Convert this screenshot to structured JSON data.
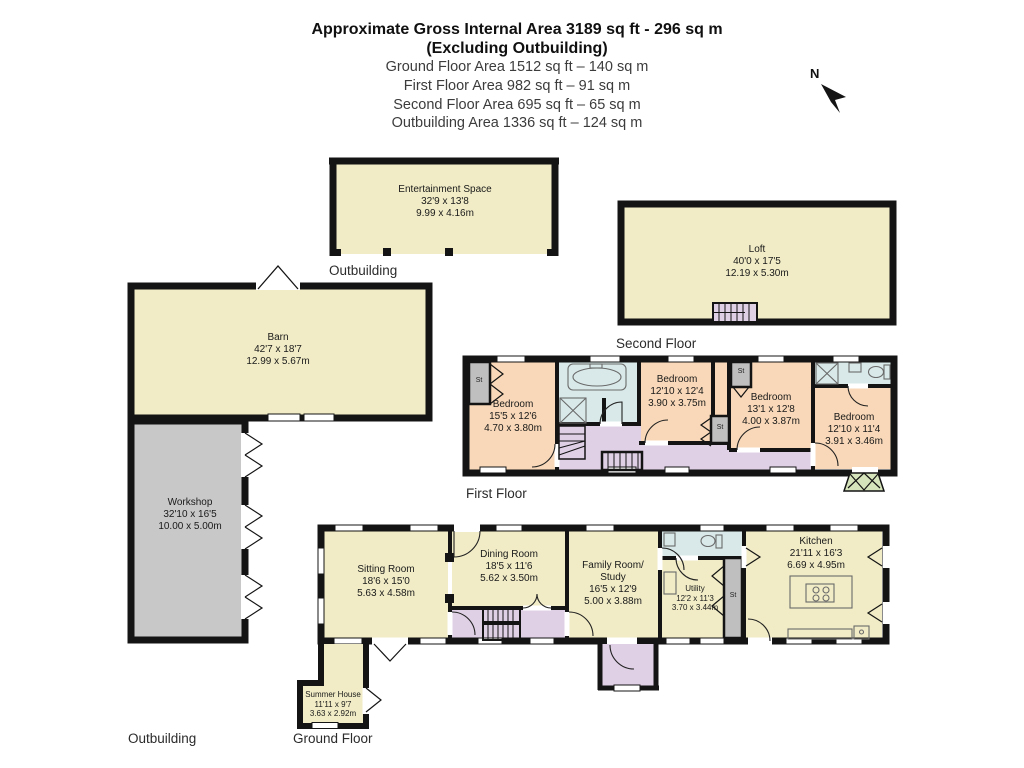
{
  "header": {
    "title": "Approximate Gross Internal Area 3189 sq ft - 296 sq m",
    "subtitle": "(Excluding Outbuilding)",
    "area_lines": [
      "Ground Floor Area 1512 sq ft – 140 sq m",
      "First Floor Area 982 sq ft – 91 sq m",
      "Second Floor Area 695 sq ft – 65 sq m",
      "Outbuilding Area 1336 sq ft – 124 sq m"
    ]
  },
  "compass": {
    "north_label": "N"
  },
  "floor_labels": {
    "outbuilding_top": "Outbuilding",
    "second_floor": "Second Floor",
    "first_floor": "First Floor",
    "outbuilding_bottom": "Outbuilding",
    "ground_floor": "Ground Floor"
  },
  "closet_label": "St",
  "rooms": {
    "entertainment_space": {
      "name": "Entertainment Space",
      "imperial": "32'9 x 13'8",
      "metric": "9.99 x 4.16m"
    },
    "loft": {
      "name": "Loft",
      "imperial": "40'0 x 17'5",
      "metric": "12.19 x 5.30m"
    },
    "barn": {
      "name": "Barn",
      "imperial": "42'7 x 18'7",
      "metric": "12.99 x 5.67m"
    },
    "workshop": {
      "name": "Workshop",
      "imperial": "32'10 x 16'5",
      "metric": "10.00 x 5.00m"
    },
    "bedroom_1": {
      "name": "Bedroom",
      "imperial": "15'5 x 12'6",
      "metric": "4.70 x 3.80m"
    },
    "bedroom_2": {
      "name": "Bedroom",
      "imperial": "12'10 x 12'4",
      "metric": "3.90 x 3.75m"
    },
    "bedroom_3": {
      "name": "Bedroom",
      "imperial": "13'1 x 12'8",
      "metric": "4.00 x 3.87m"
    },
    "bedroom_4": {
      "name": "Bedroom",
      "imperial": "12'10 x 11'4",
      "metric": "3.91 x 3.46m"
    },
    "sitting_room": {
      "name": "Sitting Room",
      "imperial": "18'6 x 15'0",
      "metric": "5.63 x 4.58m"
    },
    "dining_room": {
      "name": "Dining Room",
      "imperial": "18'5 x 11'6",
      "metric": "5.62 x 3.50m"
    },
    "family_room": {
      "name": "Family Room/",
      "name2": "Study",
      "imperial": "16'5 x 12'9",
      "metric": "5.00 x 3.88m"
    },
    "utility": {
      "name": "Utility",
      "imperial": "12'2 x 11'3",
      "metric": "3.70 x 3.44m"
    },
    "kitchen": {
      "name": "Kitchen",
      "imperial": "21'11 x 16'3",
      "metric": "6.69 x 4.95m"
    },
    "summer_house": {
      "name": "Summer House",
      "imperial": "11'11 x 9'7",
      "metric": "3.63 x 2.92m"
    }
  },
  "colors": {
    "room_cream": "#f1ecc6",
    "bedroom_peach": "#f8d8b8",
    "hall_lavender": "#e0d0e6",
    "bathroom_blue": "#d9e9e9",
    "workshop_grey": "#c8c8c8",
    "closet_grey": "#c0bfbf",
    "porch_green": "#d6e4bb",
    "wall_black": "#141414"
  }
}
